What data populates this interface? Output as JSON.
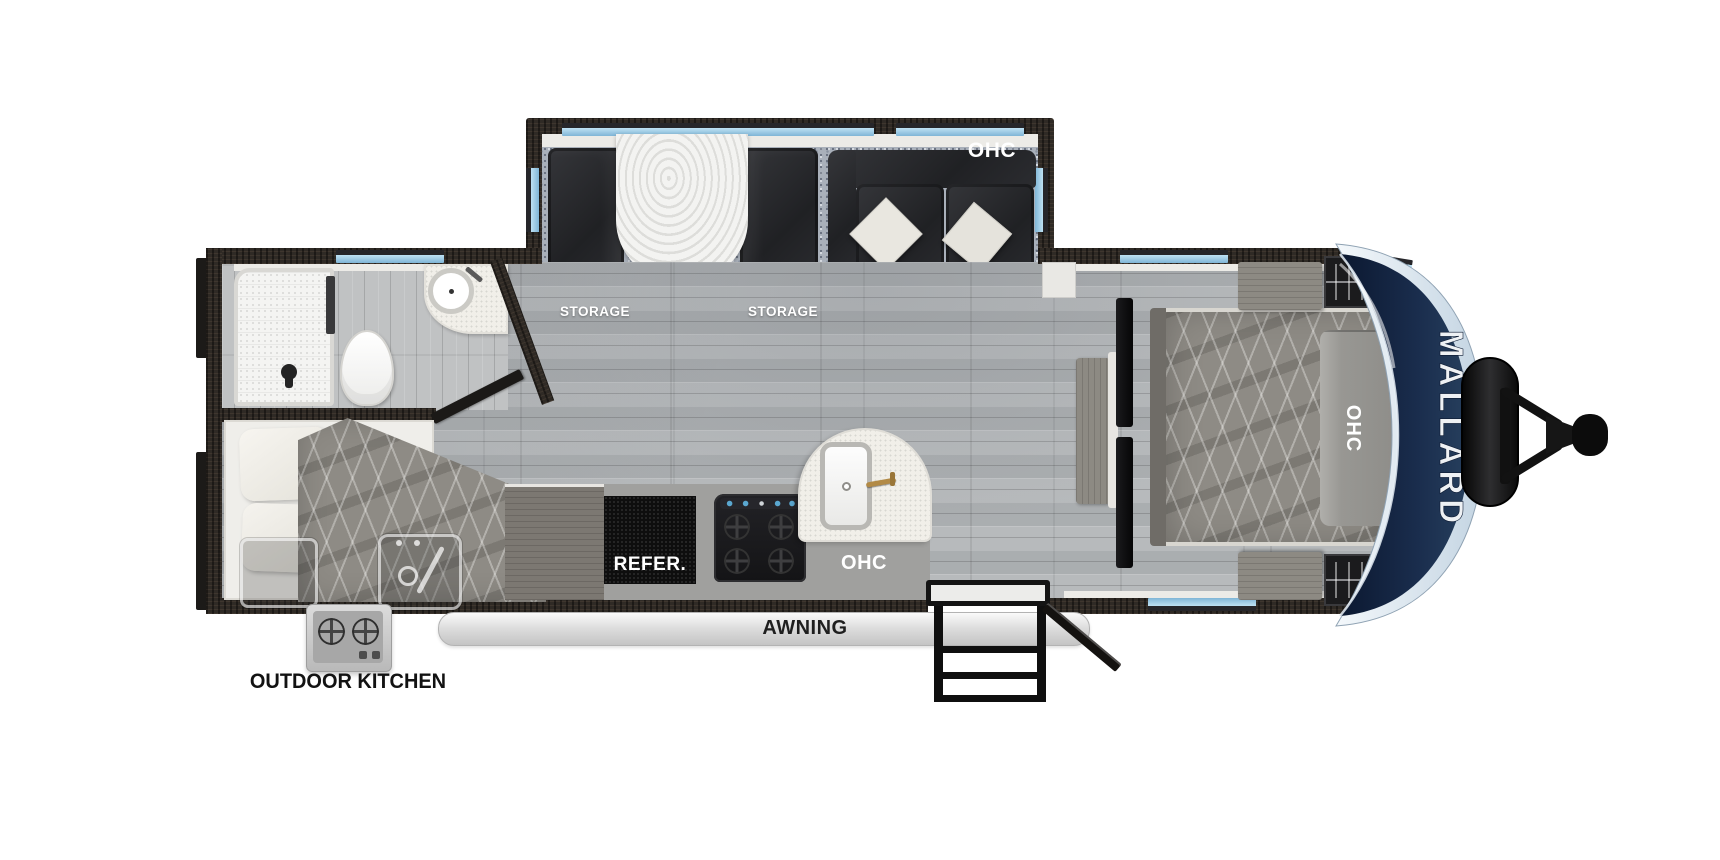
{
  "title": "Mallard travel trailer floor plan",
  "brand": "MALLARD",
  "labels": {
    "ohc": "OHC",
    "storage": "STORAGE",
    "refrigerator": "REFER.",
    "awning": "AWNING",
    "outdoor_kitchen": "OUTDOOR KITCHEN"
  },
  "colors": {
    "wall": "#2f2a25",
    "floor": "#b4b7b9",
    "carpet": "#a9b0ba",
    "furniture_dark": "#26272a",
    "bedspread": "#8e8b85",
    "counter_white": "#f1efe9",
    "counter_gray": "#a0a09e",
    "window_blue": "#9fd0ec",
    "cap_navy": "#142540",
    "cap_rim": "#d9e5f0",
    "faucet_brass": "#b28a46",
    "label_white": "#ffffff",
    "label_dark": "#121212"
  },
  "features": [
    "dinette-slideout",
    "sofa",
    "bathroom",
    "bunk-room",
    "kitchen",
    "bedroom",
    "front-cap",
    "propane-tank",
    "hitch",
    "awning",
    "entry-steps",
    "outdoor-kitchen"
  ]
}
